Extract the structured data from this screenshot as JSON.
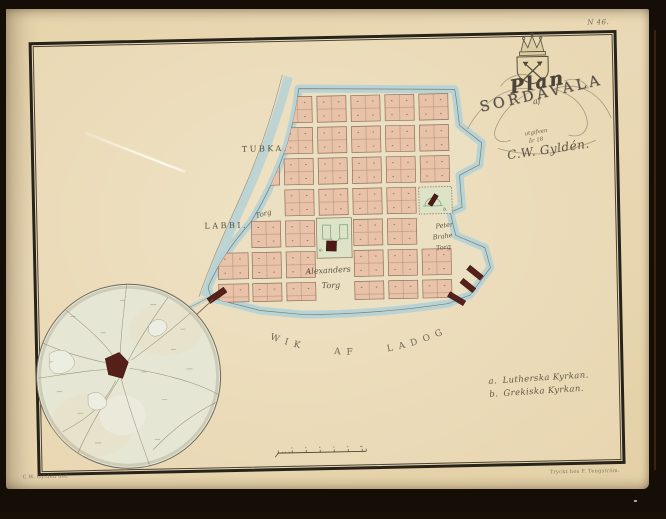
{
  "document": {
    "plate_number": "N 46.",
    "imprint_left": "C.W. Gyldén del.",
    "imprint_right": "Tryckt hos F. Tengström."
  },
  "title": {
    "word_plan": "Plan",
    "word_af": "af",
    "word_city": "SORDAVALA",
    "sub_line1": "utgifven",
    "sub_line2": "år 18",
    "signature": "C.W. Gyldén."
  },
  "map_labels": {
    "district_north": "TUBKA.",
    "district_west": "LABBI.",
    "square_west": "Torg",
    "square_central_1": "Alexanders",
    "square_central_2": "Torg",
    "square_east_1": "Peter",
    "square_east_2": "Brahe",
    "square_east_3": "Torg",
    "water_body": "WIK AF LADOGA."
  },
  "legend": {
    "items": [
      {
        "key": "a.",
        "label": "Lutherska Kyrkan."
      },
      {
        "key": "b.",
        "label": "Grekiska Kyrkan."
      }
    ]
  },
  "colors": {
    "paper": "#e9d8b4",
    "city_block": "#e9c3a9",
    "water_edge": "#b8d3d5",
    "church_building": "#4e1a15",
    "park_square": "#dce3c6",
    "inset_fill": "#e5e7d4",
    "ink": "#4c463c"
  }
}
